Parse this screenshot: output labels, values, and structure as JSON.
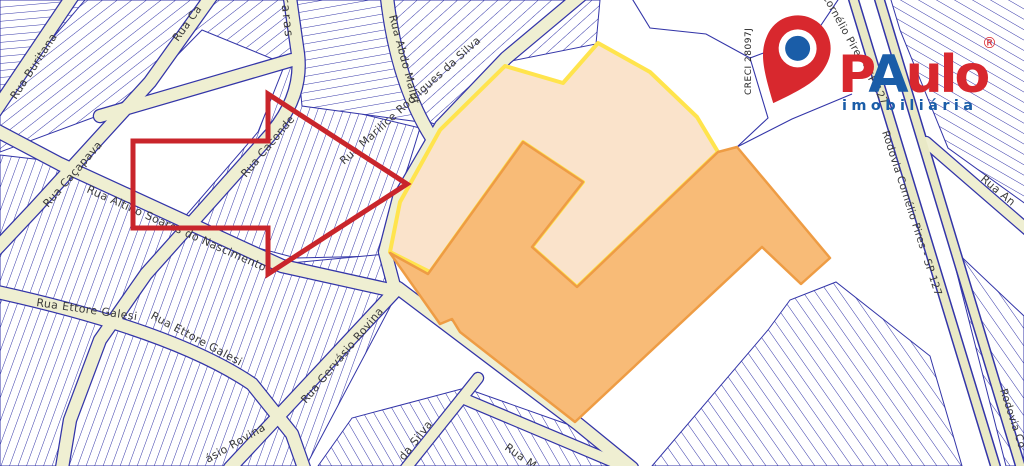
{
  "labels": [
    {
      "text": "Rua Buritana"
    },
    {
      "text": "Rua Ca"
    },
    {
      "text": "Rua Caçapava"
    },
    {
      "text": "Rua Caconde"
    },
    {
      "text": "Rua Altino Soares do Nascimento"
    },
    {
      "text": "Rua Ettore Galesi"
    },
    {
      "text": "Rua Ettore Galesi"
    },
    {
      "text": "Rua Gervásio Rovina"
    },
    {
      "text": "ásio Rovina"
    },
    {
      "text": "da Silva"
    },
    {
      "text": "Rua M"
    },
    {
      "text": "Rua Abdo Maluf"
    },
    {
      "text": "Rua Marilice Rodrigues da Silva"
    },
    {
      "text": "Rodovia Cornélio Pires - SP 127"
    },
    {
      "text": "Cornélio Pires - SP 127"
    },
    {
      "text": "Rodovia Co"
    },
    {
      "text": "Rua An"
    },
    {
      "text": "Araras"
    }
  ],
  "logo": {
    "brand_p": "P",
    "brand_a": "A",
    "brand_ulo": "ulo",
    "registered": "®",
    "subtitle": "imobiliária",
    "creci": "CRECI 28097J"
  },
  "colors": {
    "navy": "#3335a8",
    "street": "#efefd2",
    "rodovia": "#e9e9c6",
    "peach": "#fae3cb",
    "peach-border": "#ffe44d",
    "orange": "#f8bb77",
    "orange-border": "#ee9c44",
    "arrow-red": "#c9252b",
    "logo-red": "#d8282e",
    "logo-blue": "#1a5da8"
  }
}
